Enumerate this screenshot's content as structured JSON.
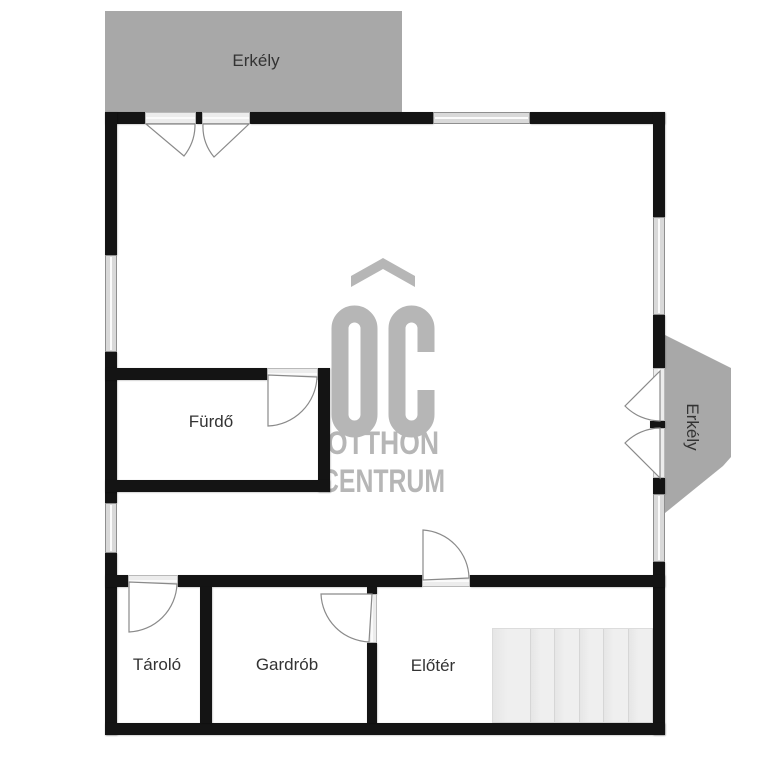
{
  "floorplan": {
    "rooms": {
      "balcony_top": "Erkély",
      "balcony_right": "Erkély",
      "bathroom": "Fürdő",
      "storage": "Tároló",
      "wardrobe": "Gardrób",
      "hall": "Előtér"
    },
    "watermark": {
      "logo": "OC",
      "line1": "OTTHON",
      "line2": "CENTRUM"
    },
    "colors": {
      "wall": "#141414",
      "balcony": "#a8a8a8",
      "watermark": "#b6b6b6",
      "stairs": "#ededed",
      "label": "#333333"
    }
  }
}
